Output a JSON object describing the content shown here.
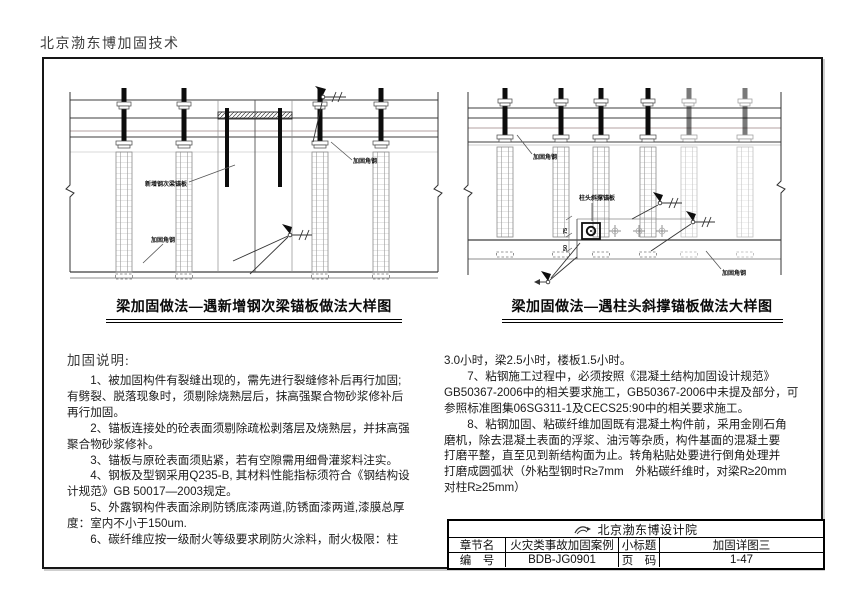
{
  "page": {
    "header": "北京渤东博加固技术"
  },
  "figures": [
    {
      "caption": "梁加固做法—遇新增钢次梁锚板做法大样图",
      "labels": {
        "plate": "新增钢次梁锚板",
        "angle_top": "加固角钢",
        "angle_bottom": "加固角钢"
      }
    },
    {
      "caption": "梁加固做法—遇柱头斜撑锚板做法大样图",
      "labels": {
        "angle_top": "加固角钢",
        "bracket": "柱头斜撑锚板",
        "angle_bottom": "加固角钢",
        "dim_a": "75",
        "dim_b": "50"
      }
    }
  ],
  "notes": {
    "title": "加固说明:",
    "left_lines": [
      "　　1、被加固构件有裂缝出现的，需先进行裂缝修补后再行加固;",
      "有劈裂、脱落现象时，须剔除烧熟层后，抹高强聚合物砂浆修补后",
      "再行加固。",
      "　　2、锚板连接处的砼表面须剔除疏松剥落层及烧熟层，并抹高强",
      "聚合物砂浆修补。",
      "　　3、锚板与原砼表面须贴紧，若有空隙需用细骨灌浆料注实。",
      "　　4、钢板及型钢采用Q235-B, 其材料性能指标须符合《钢结构设",
      "计规范》GB 50017—2003规定。",
      "　　5、外露钢构件表面涂刷防锈底漆两道,防锈面漆两道,漆膜总厚",
      "度：室内不小于150um.",
      "　　6、碳纤维应按一级耐火等级要求刷防火涂料，耐火极限：柱"
    ],
    "right_lines": [
      "3.0小时，梁2.5小时，楼板1.5小时。",
      "　　7、粘钢施工过程中，必须按照《混凝土结构加固设计规范》",
      "GB50367-2006中的相关要求施工，GB50367-2006中未提及部分，可",
      "参照标准图集06SG311-1及CECS25:90中的相关要求施工。",
      "　　8、粘钢加固、粘碳纤维加固既有混凝土构件前，采用金刚石角",
      "磨机，除去混凝土表面的浮浆、油污等杂质，构件基面的混凝土要",
      "打磨平整，直至见到新结构面为止。转角粘贴处要进行倒角处理并",
      "打磨成圆弧状（外粘型钢时R≥7mm　外粘碳纤维时，对梁R≥20mm",
      "对柱R≥25mm）"
    ]
  },
  "title_block": {
    "company": "北京渤东博设计院",
    "row1": {
      "label_a": "章节名",
      "value_a": "火灾类事故加固案例",
      "label_b": "小标题",
      "value_b": "加固详图三"
    },
    "row2": {
      "label_a": "编　号",
      "value_a": "BDB-JG0901",
      "label_b": "页　码",
      "value_b": "1-47"
    }
  }
}
